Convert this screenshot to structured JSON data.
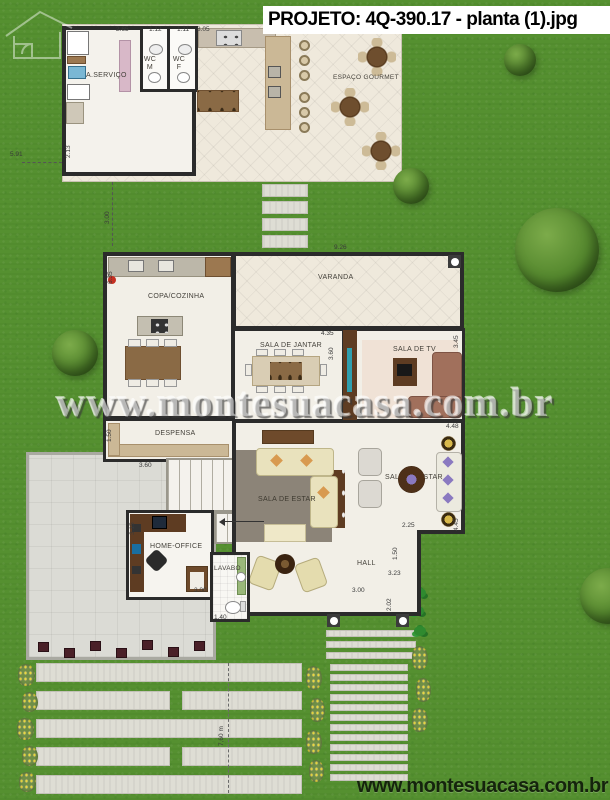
{
  "title": "PROJETO: 4Q-390.17 - planta (1).jpg",
  "watermark": "www.montesuacasa.com.br",
  "footer": "www.montesuacasa.com.br",
  "rooms": {
    "servico": "A.SERVIÇO",
    "wc_m": "WC M",
    "wc_f": "WC F",
    "gourmet": "ESPAÇO GOURMET",
    "varanda": "VARANDA",
    "copa": "COPA/COZINHA",
    "jantar": "SALA DE JANTAR",
    "tv": "SALA DE TV",
    "despensa": "DESPENSA",
    "estar1": "SALA DE ESTAR",
    "estar2": "SALA DE ESTAR",
    "office": "HOME-OFFICE",
    "lavabo": "LAVABO",
    "hall": "HALL"
  },
  "dims": {
    "annex_w1": "2.65",
    "annex_w2": "1.12",
    "annex_w3": "1.11",
    "annex_w4": "8.05",
    "lot_left": "5.91",
    "annex_h": "2.13",
    "gap": "3.00",
    "kitchen_h": "6.35",
    "varanda_w": "9.26",
    "jantar_w": "4.35",
    "jantar_h": "3.60",
    "tv_h": "3.45",
    "tv_w": "4.48",
    "despensa_h": "1.50",
    "despensa_w": "3.60",
    "office_h": "3.15",
    "office_w": "3.00",
    "lavabo_w": "1.40",
    "estar_w": "3.00",
    "estar2_w": "2.25",
    "estar2_h": "4.45",
    "hall_h1": "1.50",
    "hall_w": "3.23",
    "hall_h2": "2.02",
    "drive_len": "7,60 m"
  },
  "colors": {
    "grass": "#559030",
    "wall": "#2b2b2b",
    "floor": "#f1ece1",
    "wood": "#6e4a2b",
    "aquarium": "#2f9fae",
    "sofa_beige": "#e9e2bd"
  }
}
